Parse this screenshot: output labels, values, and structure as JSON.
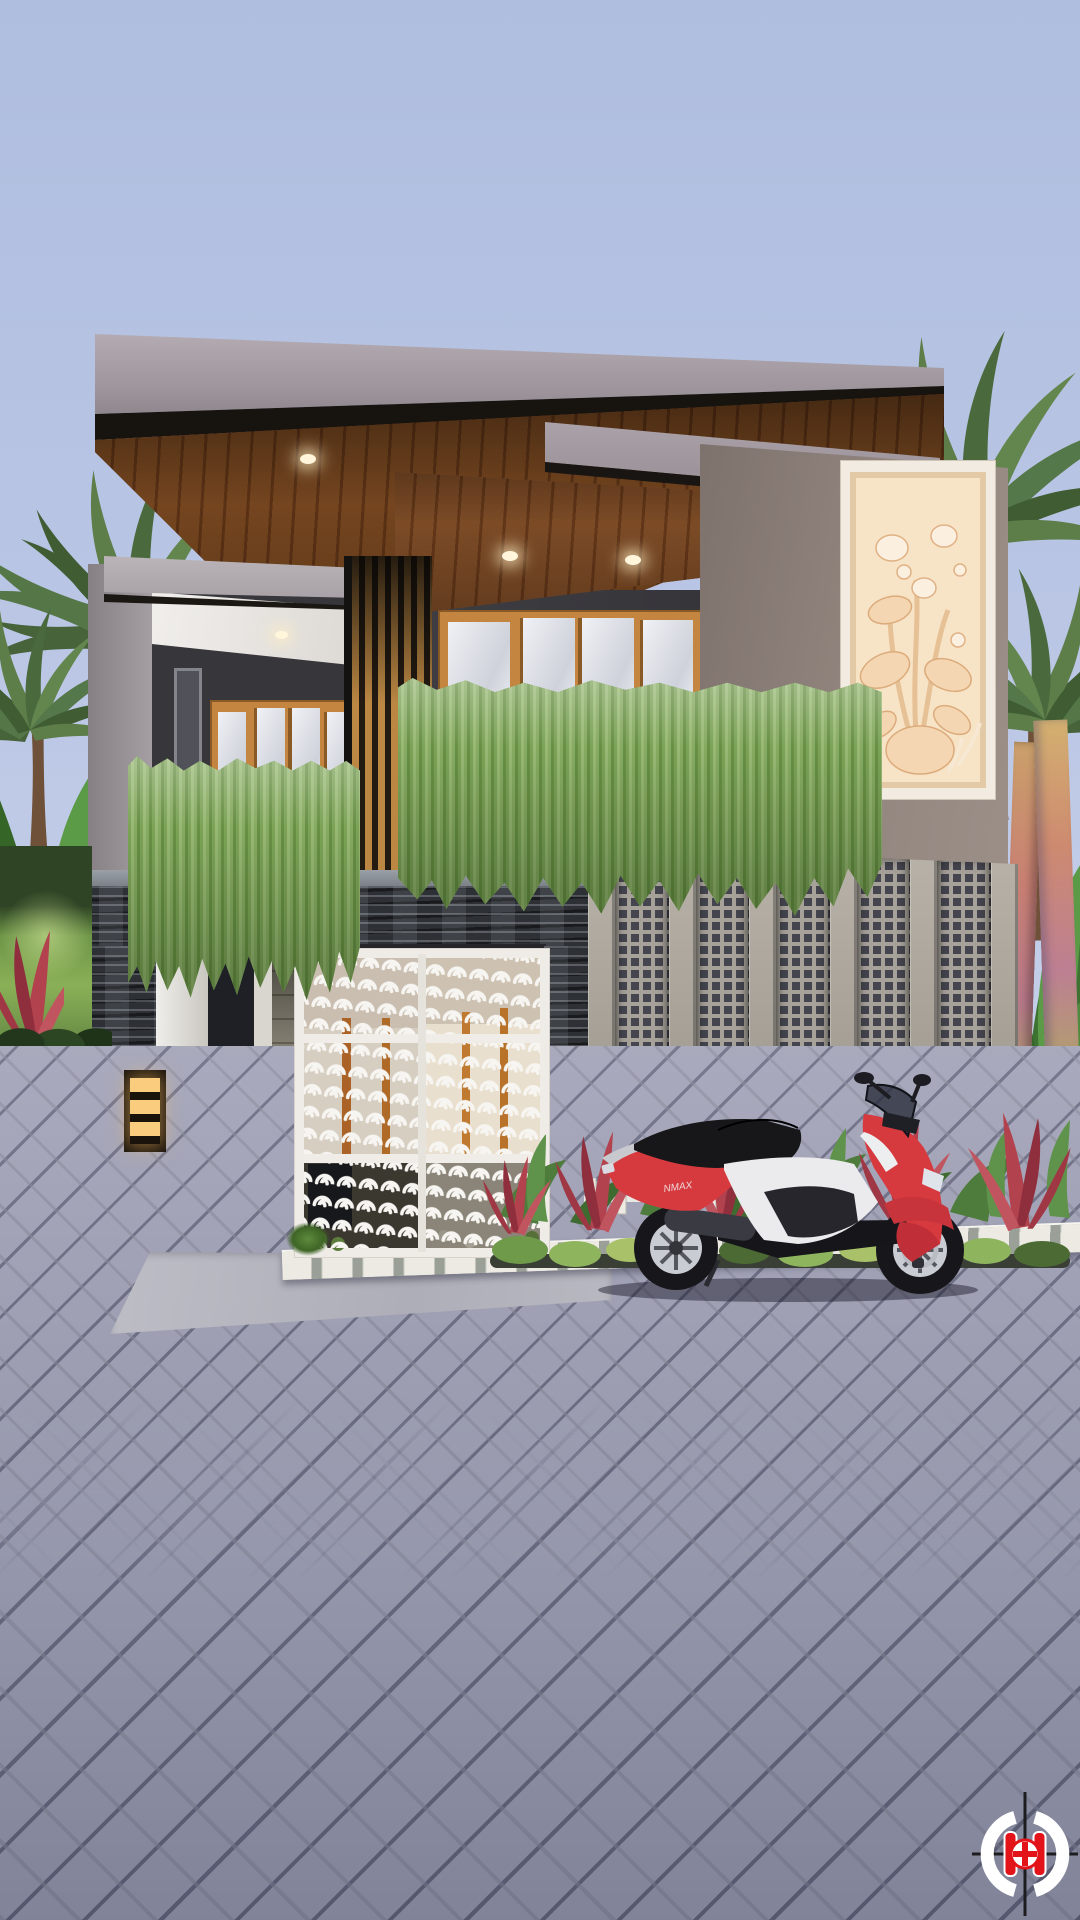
{
  "scene": {
    "type": "3d-architectural-exterior-render",
    "subject": "modern two-storey tropical house with carport, ornamental gate and breeze-block wall",
    "license_plate": "A 224 HRA",
    "scooter_badge": "NMAX",
    "palette": {
      "sky_top": "#afbddf",
      "sky_bottom": "#d4dbef",
      "roof_fascia": "#a49ca2",
      "wood_soffit": "#6d3f1e",
      "wood_slats": "#bb8743",
      "charcoal_wall": "#3b3a3f",
      "taupe_wall": "#8b7e78",
      "stone_slate": "#2d3034",
      "relief_panel_cream": "#f0d4ae",
      "gate_white": "#efece7",
      "foliage_green": "#6d9449",
      "cordyline_red": "#b2424e",
      "paver_gray": "#9fa0b5",
      "scooter_red": "#d63a3f",
      "car_black": "#111114",
      "logo_red": "#e21319",
      "downlight_warm": "#f9e9c8"
    }
  }
}
